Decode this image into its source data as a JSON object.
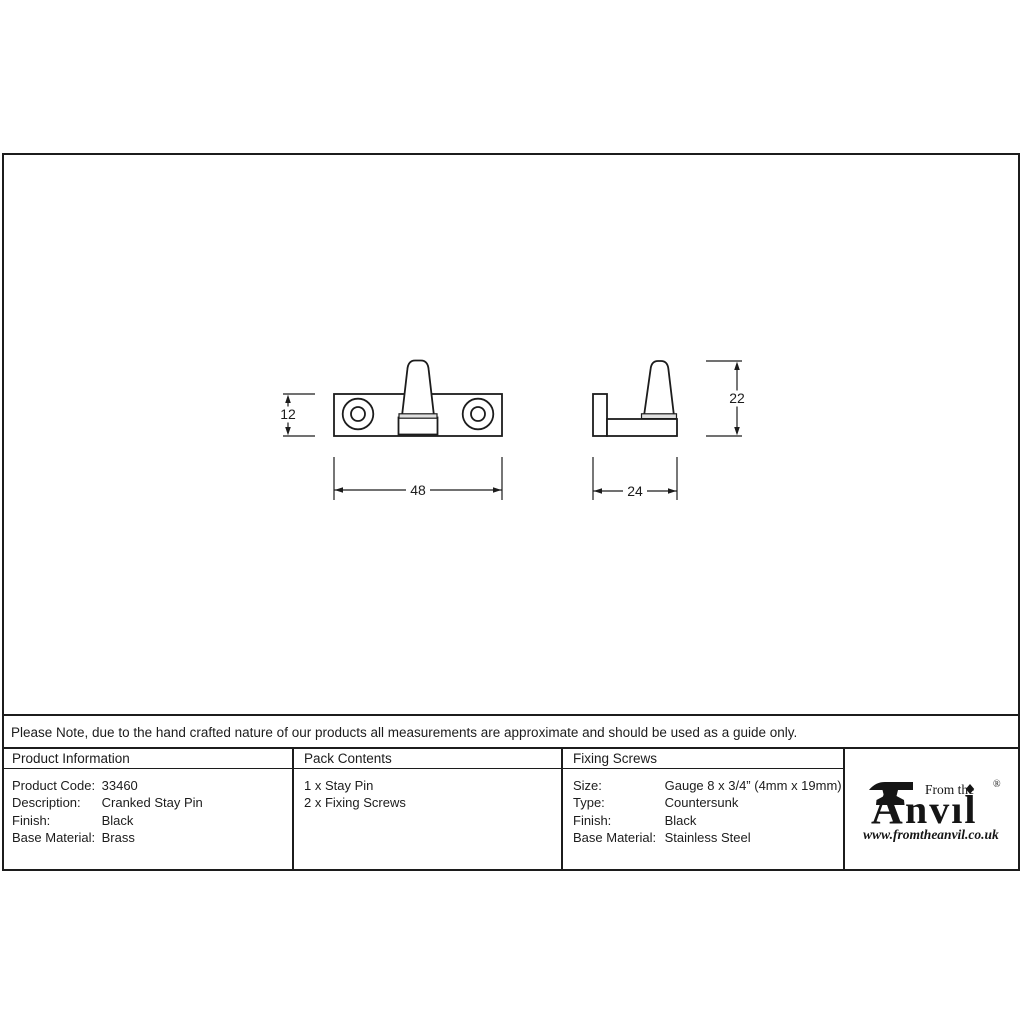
{
  "note": "Please Note, due to the hand crafted nature of our products all measurements are approximate and should be used as a guide only.",
  "drawings": {
    "front_view": {
      "name": "stay pin front elevation",
      "height_label": "12",
      "width_label": "48"
    },
    "side_view": {
      "name": "stay pin side profile",
      "height_label": "22",
      "width_label": "24"
    }
  },
  "table": {
    "product_information": {
      "header": "Product Information",
      "rows": [
        {
          "label": "Product Code:",
          "value": "33460"
        },
        {
          "label": "Description:",
          "value": "Cranked Stay Pin"
        },
        {
          "label": "Finish:",
          "value": "Black"
        },
        {
          "label": "Base Material:",
          "value": "Brass"
        }
      ]
    },
    "pack_contents": {
      "header": "Pack Contents",
      "items": [
        "1 x Stay Pin",
        "2 x Fixing Screws"
      ]
    },
    "fixing_screws": {
      "header": "Fixing Screws",
      "rows": [
        {
          "label": "Size:",
          "value": "Gauge 8 x 3/4” (4mm x 19mm)"
        },
        {
          "label": "Type:",
          "value": "Countersunk"
        },
        {
          "label": "Finish:",
          "value": "Black"
        },
        {
          "label": "Base Material:",
          "value": "Stainless Steel"
        }
      ]
    }
  },
  "logo": {
    "brand_prefix": "From the",
    "brand_a": "A",
    "brand_rest": "nvıl",
    "registered_mark": "®",
    "url": "www.fromtheanvil.co.uk"
  },
  "colors": {
    "line": "#1c1c1c",
    "background": "#ffffff",
    "foot_shade": "#e0e0e0"
  }
}
